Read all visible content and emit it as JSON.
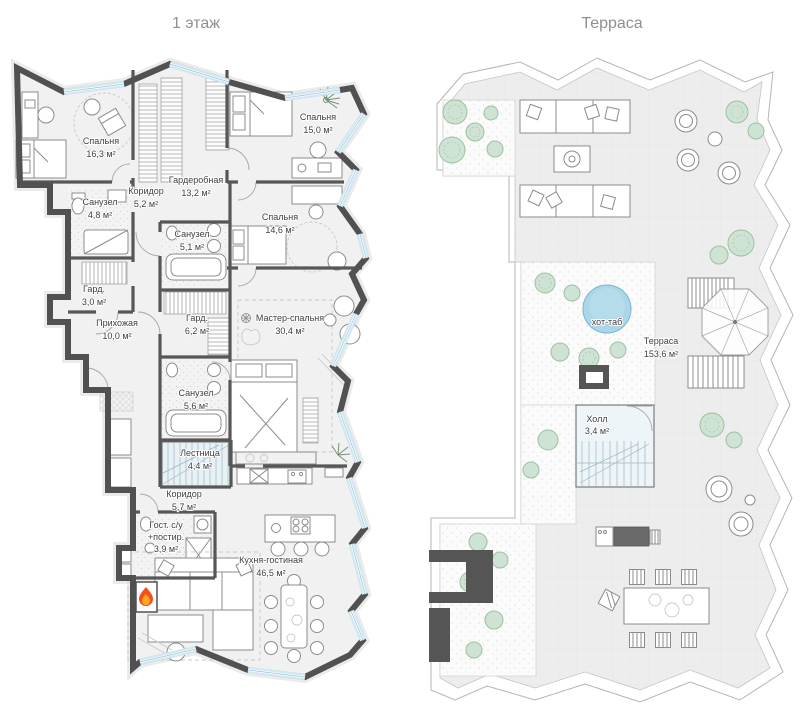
{
  "plans": {
    "floor1": {
      "title": "1 этаж",
      "rooms": [
        {
          "name": "Спальня",
          "area": "16,3 м²"
        },
        {
          "name": "Спальня",
          "area": "15,0 м²"
        },
        {
          "name": "Коридор",
          "area": "5,2 м²"
        },
        {
          "name": "Гардеробная",
          "area": "13,2 м²"
        },
        {
          "name": "Санузел",
          "area": "4,8 м²"
        },
        {
          "name": "Санузел",
          "area": "5,1 м²"
        },
        {
          "name": "Спальня",
          "area": "14,6 м²"
        },
        {
          "name": "Гард.",
          "area": "3,0 м²"
        },
        {
          "name": "Гард.",
          "area": "6,2 м²"
        },
        {
          "name": "Прихожая",
          "area": "10,0 м²"
        },
        {
          "name": "Мастер-спальня",
          "area": "30,4 м²"
        },
        {
          "name": "Санузел",
          "area": "5,6 м²"
        },
        {
          "name": "Лестница",
          "area": "4,4 м²"
        },
        {
          "name": "Коридор",
          "area": "5,7 м²"
        },
        {
          "name": "Гост. с/у",
          "name2": "+постир.",
          "area": "3,9 м²"
        },
        {
          "name": "Кухня-гостиная",
          "area": "46,5 м²"
        }
      ]
    },
    "terrace": {
      "title": "Терраса",
      "rooms": [
        {
          "name": "хот-таб"
        },
        {
          "name": "Терраса",
          "area": "153,6 м²"
        },
        {
          "name": "Холл",
          "area": "3,4 м²"
        }
      ]
    }
  },
  "colors": {
    "wall": "#515151",
    "glazing": "#cfe8f2",
    "floor": "#f1f1f1",
    "terrace_floor": "#ededed",
    "tree": "#cfe3d4",
    "hot_tub": "#a9d6e9",
    "stairs": "#e8f1f6",
    "flame_outer": "#f4511e",
    "flame_inner": "#ffa726"
  }
}
